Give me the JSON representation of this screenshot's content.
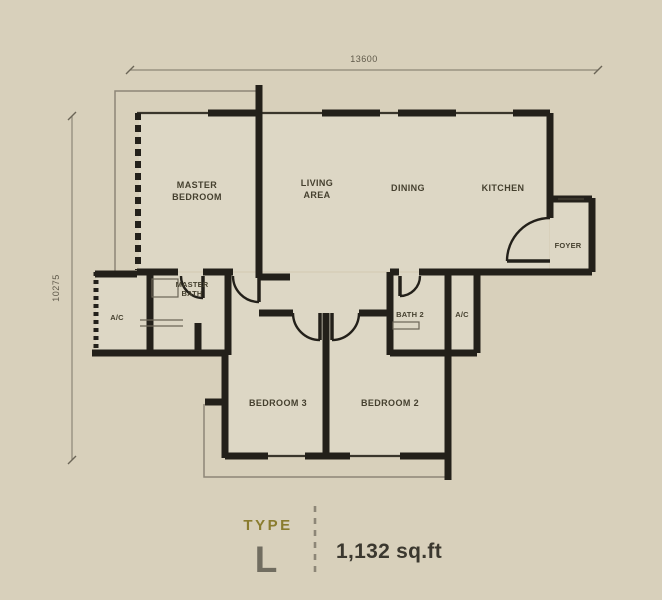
{
  "dimensions": {
    "width_label": "13600",
    "height_label": "10275"
  },
  "rooms": {
    "master_bedroom": {
      "line1": "MASTER",
      "line2": "BEDROOM"
    },
    "living_area": {
      "line1": "LIVING",
      "line2": "AREA"
    },
    "dining": {
      "label": "DINING"
    },
    "kitchen": {
      "label": "KITCHEN"
    },
    "foyer": {
      "label": "FOYER"
    },
    "master_bath": {
      "line1": "MASTER",
      "line2": "BATH"
    },
    "ac_left": {
      "label": "A/C"
    },
    "bath2": {
      "label": "BATH 2"
    },
    "ac_right": {
      "label": "A/C"
    },
    "bedroom3": {
      "label": "BEDROOM 3"
    },
    "bedroom2": {
      "label": "BEDROOM 2"
    }
  },
  "footer": {
    "type_label": "TYPE",
    "type_value": "L",
    "area": "1,132 sq.ft"
  },
  "colors": {
    "background": "#d8d0bb",
    "room_fill": "#ddd7c5",
    "wall": "#23201a",
    "thin_line": "#8d8677",
    "label_text": "#45402f",
    "type_accent": "#8a7c2e",
    "area_text": "#3b382f"
  }
}
